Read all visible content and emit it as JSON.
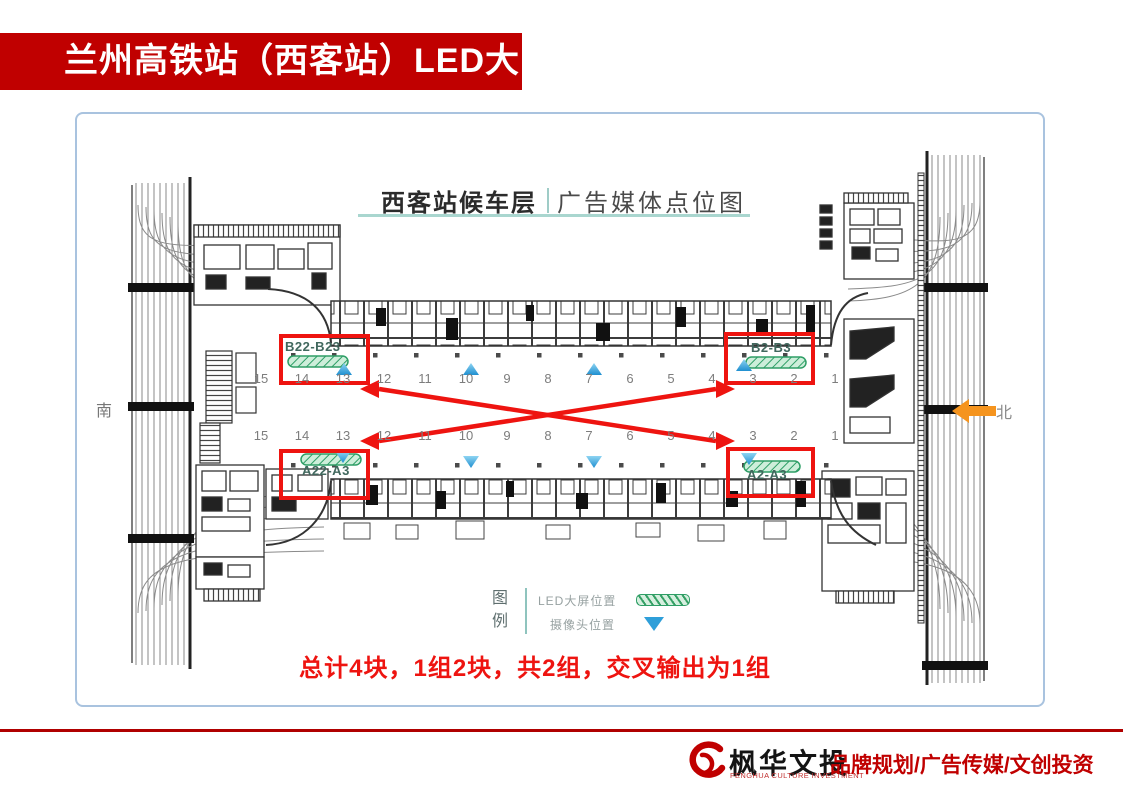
{
  "slide": {
    "title": "兰州高铁站（西客站）LED大屏"
  },
  "map": {
    "title_primary": "西客站候车层",
    "title_secondary": "广告媒体点位图",
    "compass_south": "南",
    "compass_north": "北",
    "led_markers": [
      {
        "label": "B22-B23",
        "position": "upper-left"
      },
      {
        "label": "B2-B3",
        "position": "upper-right"
      },
      {
        "label": "A22-A3",
        "position": "lower-left"
      },
      {
        "label": "A2-A3",
        "position": "lower-right"
      }
    ],
    "gate_numbers": [
      "15",
      "14",
      "13",
      "12",
      "11",
      "10",
      "9",
      "8",
      "7",
      "6",
      "5",
      "4",
      "3",
      "2",
      "1"
    ],
    "legend": {
      "title": "图例",
      "items": [
        {
          "label": "LED大屏位置",
          "symbol": "led-strip-swatch"
        },
        {
          "label": "摄像头位置",
          "symbol": "camera-triangle-swatch"
        }
      ]
    },
    "summary": "总计4块，1组2块，共2组，交叉输出为1组"
  },
  "footer": {
    "logo_cn": "枫华文投",
    "logo_en": "FENGHUA CULTURE INVESTMENT",
    "tagline": "品牌规划/广告传媒/文创投资"
  },
  "colors": {
    "banner_red": "#c00000",
    "highlight_red": "#ee1410",
    "teal_accent": "#9fccc7",
    "led_green": "#2e9e66",
    "camera_blue": "#2f9fd9",
    "north_orange": "#f5941e"
  }
}
